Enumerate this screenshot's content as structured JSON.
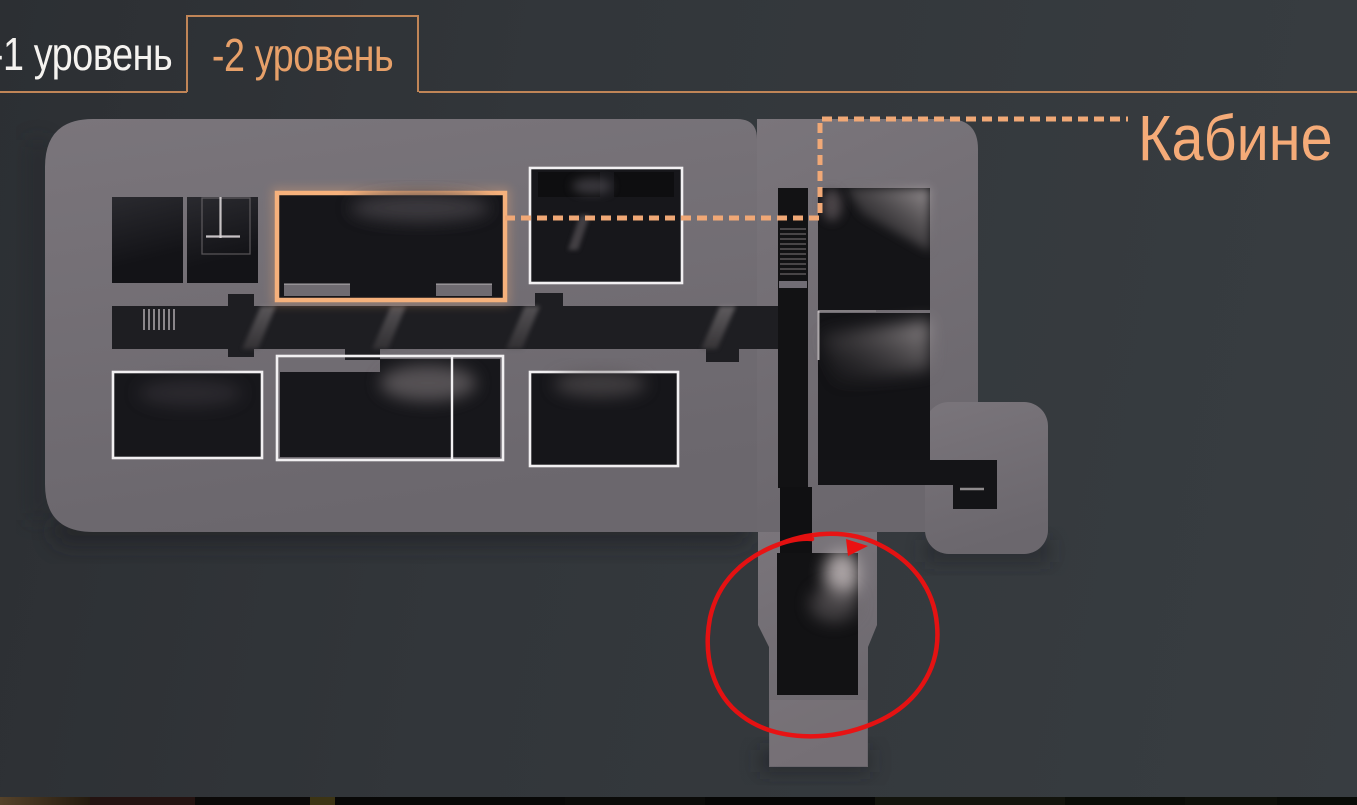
{
  "header": {
    "tabs": [
      {
        "label": "-1 уровень",
        "active": false
      },
      {
        "label": "-2 уровень",
        "active": true
      }
    ]
  },
  "callout": {
    "label": "Кабине"
  },
  "map": {
    "highlighted_room": "orange-outline-room",
    "annotated_room": "red-circle-room",
    "outlined_rooms": 4
  },
  "colors": {
    "page_background": "#32363a",
    "building_fill": "#716d73",
    "tab_border": "#c08557",
    "tab_active_text": "#e7a069",
    "tab_inactive_text": "#f5f3f0",
    "room_outline_white": "#f2f0f2",
    "room_highlight_orange": "#f6b17c",
    "leader_dash_orange": "#f0a876",
    "callout_text": "#f5ab78",
    "annotation_red": "#ea1111"
  }
}
